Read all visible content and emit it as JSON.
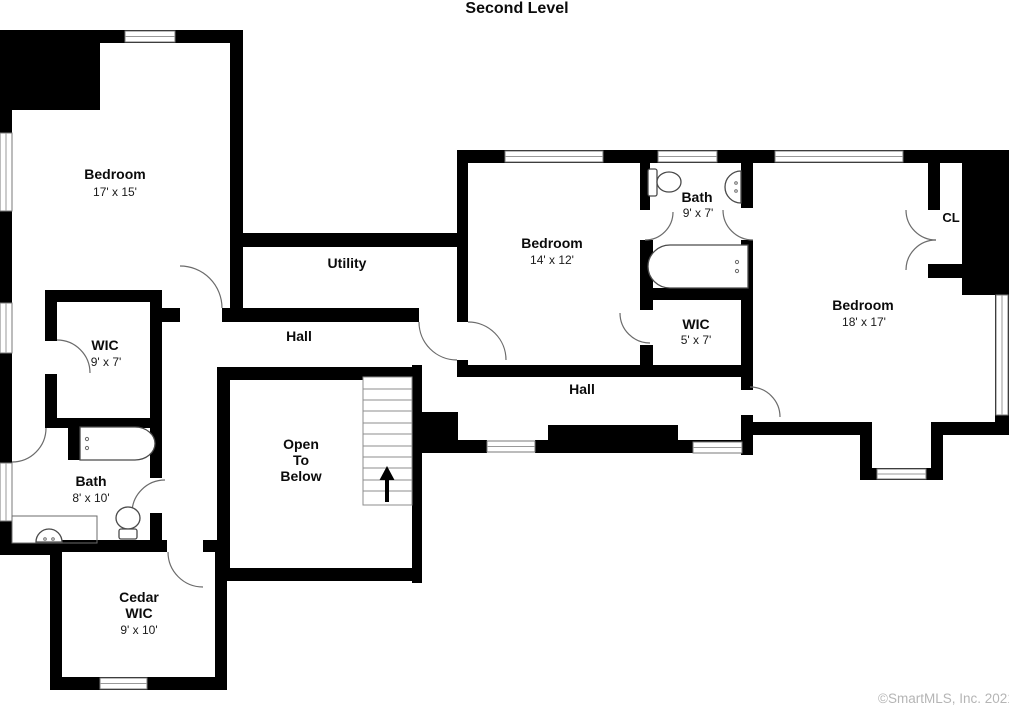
{
  "title": "Second Level",
  "watermark": "©SmartMLS, Inc. 2021",
  "colors": {
    "wall": "#000000",
    "background": "#ffffff",
    "watermark": "#b5b5b5"
  },
  "icons": {
    "stairs_arrow": "up-arrow",
    "doors": "quarter-circle-swing",
    "windows": "double-line-window"
  },
  "rooms": {
    "bedroom_tl": {
      "label": "Bedroom",
      "dims": "17' x 15'"
    },
    "utility": {
      "label": "Utility"
    },
    "wic_tl": {
      "label": "WIC",
      "dims": "9' x 7'"
    },
    "hall_left": {
      "label": "Hall"
    },
    "bath_left": {
      "label": "Bath",
      "dims": "8' x 10'"
    },
    "cedar_wic": {
      "label_line1": "Cedar",
      "label_line2": "WIC",
      "dims": "9' x 10'"
    },
    "open_below": {
      "label_line1": "Open",
      "label_line2": "To",
      "label_line3": "Below"
    },
    "bedroom_mid": {
      "label": "Bedroom",
      "dims": "14' x 12'"
    },
    "bath_mid": {
      "label": "Bath",
      "dims": "9' x 7'"
    },
    "wic_mid": {
      "label": "WIC",
      "dims": "5' x 7'"
    },
    "bedroom_right": {
      "label": "Bedroom",
      "dims": "18' x 17'"
    },
    "closet": {
      "label": "CL"
    },
    "hall_right": {
      "label": "Hall"
    }
  }
}
